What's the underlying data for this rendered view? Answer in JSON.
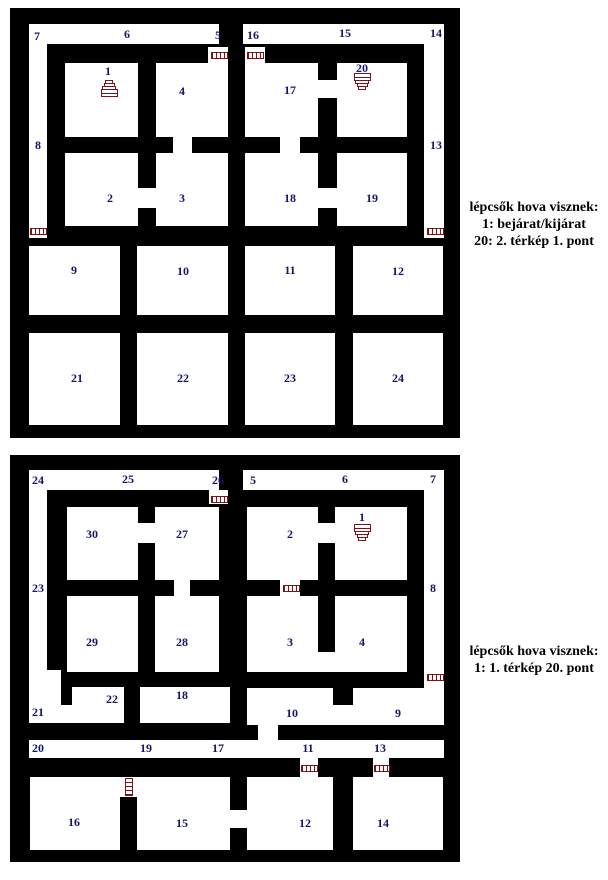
{
  "colors": {
    "wall": "#000000",
    "floor": "#ffffff",
    "label": "#151569",
    "icon": "#7d1216",
    "legend_text": "#000000"
  },
  "legends": [
    {
      "id": "legend-1",
      "lines": [
        "lépcsők hova visznek:",
        "1: bejárat/kijárat",
        "20: 2. térkép 1. pont"
      ]
    },
    {
      "id": "legend-2",
      "lines": [
        "lépcsők hova visznek:",
        "1: 1. térkép 20. pont"
      ]
    }
  ],
  "maps": [
    {
      "name": "map-1",
      "x": 10,
      "y": 8,
      "width": 450,
      "height": 430,
      "floors": [
        [
          19,
          16,
          190,
          20
        ],
        [
          233,
          16,
          201,
          20
        ],
        [
          19,
          16,
          18,
          214
        ],
        [
          414,
          16,
          20,
          214
        ],
        [
          198,
          39,
          20,
          16
        ],
        [
          235,
          39,
          20,
          16
        ],
        [
          55,
          55,
          73,
          74
        ],
        [
          146,
          55,
          72,
          74
        ],
        [
          235,
          55,
          73,
          74
        ],
        [
          327,
          55,
          70,
          74
        ],
        [
          55,
          145,
          73,
          73
        ],
        [
          146,
          145,
          72,
          73
        ],
        [
          235,
          145,
          73,
          73
        ],
        [
          327,
          145,
          70,
          73
        ],
        [
          163,
          129,
          19,
          16
        ],
        [
          128,
          180,
          18,
          20
        ],
        [
          308,
          72,
          19,
          18
        ],
        [
          308,
          180,
          19,
          20
        ],
        [
          270,
          129,
          20,
          16
        ],
        [
          19,
          238,
          91,
          69
        ],
        [
          127,
          238,
          91,
          69
        ],
        [
          235,
          238,
          90,
          69
        ],
        [
          343,
          238,
          90,
          69
        ],
        [
          19,
          325,
          91,
          92
        ],
        [
          127,
          325,
          91,
          92
        ],
        [
          235,
          325,
          90,
          92
        ],
        [
          343,
          325,
          90,
          92
        ]
      ],
      "walls": [],
      "labels": [
        {
          "t": "7",
          "x": 27,
          "y": 28
        },
        {
          "t": "6",
          "x": 117,
          "y": 26
        },
        {
          "t": "5",
          "x": 208,
          "y": 27
        },
        {
          "t": "16",
          "x": 243,
          "y": 27
        },
        {
          "t": "15",
          "x": 335,
          "y": 25
        },
        {
          "t": "14",
          "x": 426,
          "y": 25
        },
        {
          "t": "8",
          "x": 28,
          "y": 137
        },
        {
          "t": "13",
          "x": 426,
          "y": 137
        },
        {
          "t": "1",
          "x": 98,
          "y": 63
        },
        {
          "t": "4",
          "x": 172,
          "y": 83
        },
        {
          "t": "17",
          "x": 280,
          "y": 82
        },
        {
          "t": "20",
          "x": 352,
          "y": 60
        },
        {
          "t": "2",
          "x": 100,
          "y": 190
        },
        {
          "t": "3",
          "x": 172,
          "y": 190
        },
        {
          "t": "18",
          "x": 280,
          "y": 190
        },
        {
          "t": "19",
          "x": 362,
          "y": 190
        },
        {
          "t": "9",
          "x": 64,
          "y": 262
        },
        {
          "t": "10",
          "x": 173,
          "y": 263
        },
        {
          "t": "11",
          "x": 280,
          "y": 262
        },
        {
          "t": "12",
          "x": 388,
          "y": 263
        },
        {
          "t": "21",
          "x": 67,
          "y": 370
        },
        {
          "t": "22",
          "x": 173,
          "y": 370
        },
        {
          "t": "23",
          "x": 280,
          "y": 370
        },
        {
          "t": "24",
          "x": 388,
          "y": 370
        }
      ],
      "ladders": [
        {
          "x": 201,
          "y": 44,
          "w": 17,
          "h": 7,
          "o": "h"
        },
        {
          "x": 237,
          "y": 44,
          "w": 17,
          "h": 7,
          "o": "h"
        },
        {
          "x": 20,
          "y": 220,
          "w": 17,
          "h": 7,
          "o": "h"
        },
        {
          "x": 417,
          "y": 220,
          "w": 17,
          "h": 7,
          "o": "h"
        }
      ],
      "stairs": [
        {
          "dir": "up",
          "cx": 99,
          "cy": 82
        },
        {
          "dir": "down",
          "cx": 352,
          "cy": 75
        }
      ]
    },
    {
      "name": "map-2",
      "x": 10,
      "y": 455,
      "width": 450,
      "height": 407,
      "floors": [
        [
          19,
          15,
          190,
          20
        ],
        [
          233,
          15,
          201,
          20
        ],
        [
          19,
          15,
          18,
          253
        ],
        [
          414,
          15,
          20,
          255
        ],
        [
          37,
          215,
          14,
          53
        ],
        [
          19,
          250,
          95,
          18
        ],
        [
          199,
          35,
          19,
          14
        ],
        [
          57,
          52,
          71,
          73
        ],
        [
          145,
          52,
          64,
          73
        ],
        [
          128,
          68,
          17,
          20
        ],
        [
          237,
          52,
          71,
          73
        ],
        [
          325,
          52,
          72,
          73
        ],
        [
          308,
          68,
          17,
          20
        ],
        [
          164,
          123,
          16,
          18
        ],
        [
          270,
          123,
          20,
          18
        ],
        [
          57,
          141,
          71,
          76
        ],
        [
          145,
          141,
          64,
          76
        ],
        [
          237,
          141,
          160,
          76
        ],
        [
          62,
          232,
          52,
          36
        ],
        [
          130,
          232,
          90,
          36
        ],
        [
          237,
          233,
          196,
          37
        ],
        [
          248,
          270,
          20,
          15
        ],
        [
          19,
          285,
          415,
          18
        ],
        [
          290,
          303,
          18,
          20
        ],
        [
          363,
          303,
          16,
          20
        ],
        [
          110,
          322,
          17,
          20
        ],
        [
          218,
          355,
          19,
          18
        ],
        [
          20,
          322,
          90,
          73
        ],
        [
          127,
          322,
          93,
          73
        ],
        [
          237,
          322,
          86,
          73
        ],
        [
          343,
          322,
          90,
          73
        ]
      ],
      "walls": [
        [
          308,
          141,
          17,
          56
        ],
        [
          323,
          233,
          20,
          17
        ]
      ],
      "labels": [
        {
          "t": "24",
          "x": 28,
          "y": 25
        },
        {
          "t": "25",
          "x": 118,
          "y": 24
        },
        {
          "t": "26",
          "x": 208,
          "y": 25
        },
        {
          "t": "5",
          "x": 243,
          "y": 25
        },
        {
          "t": "6",
          "x": 335,
          "y": 24
        },
        {
          "t": "7",
          "x": 423,
          "y": 24
        },
        {
          "t": "23",
          "x": 28,
          "y": 133
        },
        {
          "t": "8",
          "x": 423,
          "y": 133
        },
        {
          "t": "30",
          "x": 82,
          "y": 79
        },
        {
          "t": "27",
          "x": 172,
          "y": 79
        },
        {
          "t": "2",
          "x": 280,
          "y": 79
        },
        {
          "t": "1",
          "x": 352,
          "y": 62
        },
        {
          "t": "29",
          "x": 82,
          "y": 187
        },
        {
          "t": "28",
          "x": 172,
          "y": 187
        },
        {
          "t": "3",
          "x": 280,
          "y": 187
        },
        {
          "t": "4",
          "x": 352,
          "y": 187
        },
        {
          "t": "21",
          "x": 28,
          "y": 257
        },
        {
          "t": "22",
          "x": 102,
          "y": 244
        },
        {
          "t": "18",
          "x": 172,
          "y": 240
        },
        {
          "t": "10",
          "x": 282,
          "y": 258
        },
        {
          "t": "9",
          "x": 388,
          "y": 258
        },
        {
          "t": "20",
          "x": 28,
          "y": 293
        },
        {
          "t": "19",
          "x": 136,
          "y": 293
        },
        {
          "t": "17",
          "x": 208,
          "y": 293
        },
        {
          "t": "11",
          "x": 298,
          "y": 293
        },
        {
          "t": "13",
          "x": 370,
          "y": 293
        },
        {
          "t": "16",
          "x": 64,
          "y": 367
        },
        {
          "t": "15",
          "x": 172,
          "y": 368
        },
        {
          "t": "12",
          "x": 295,
          "y": 368
        },
        {
          "t": "14",
          "x": 373,
          "y": 368
        }
      ],
      "ladders": [
        {
          "x": 201,
          "y": 41,
          "w": 17,
          "h": 7,
          "o": "h"
        },
        {
          "x": 273,
          "y": 130,
          "w": 17,
          "h": 7,
          "o": "h"
        },
        {
          "x": 417,
          "y": 219,
          "w": 17,
          "h": 7,
          "o": "h"
        },
        {
          "x": 291,
          "y": 310,
          "w": 17,
          "h": 7,
          "o": "h"
        },
        {
          "x": 364,
          "y": 310,
          "w": 16,
          "h": 7,
          "o": "h"
        },
        {
          "x": 115,
          "y": 323,
          "w": 8,
          "h": 18,
          "o": "v"
        }
      ],
      "stairs": [
        {
          "dir": "down",
          "cx": 352,
          "cy": 79
        }
      ]
    }
  ]
}
